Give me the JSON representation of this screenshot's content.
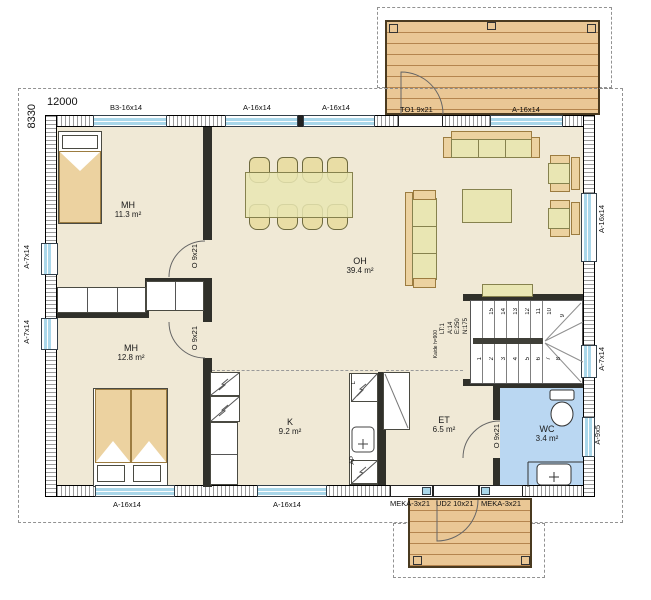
{
  "plan": {
    "dims": {
      "w": "12000",
      "h": "8330"
    },
    "rooms": {
      "mh1": {
        "name": "MH",
        "area": "11.3 m²"
      },
      "mh2": {
        "name": "MH",
        "area": "12.8 m²"
      },
      "oh": {
        "name": "OH",
        "area": "39.4 m²"
      },
      "k": {
        "name": "K",
        "area": "9.2 m²"
      },
      "et": {
        "name": "ET",
        "area": "6.5 m²"
      },
      "wc": {
        "name": "WC",
        "area": "3.4 m²"
      }
    },
    "windows": {
      "top": [
        "B3-16x14",
        "A-16x14",
        "A-16x14"
      ],
      "terrace_window": "A-16x14",
      "left": [
        "A-7x14",
        "A-7x14"
      ],
      "right": [
        "A-16x14",
        "A-7x14",
        "A-9x5"
      ],
      "bottom": [
        "A-16x14",
        "A-16x14"
      ]
    },
    "doors": {
      "terrace": "TO1 9x21",
      "entry": "UD2 10x21",
      "entry_sidelights": [
        "MEKA-3x21",
        "MEKA-3x21"
      ],
      "interior": [
        "O 9x21",
        "O 9x21",
        "O 9x21"
      ]
    },
    "stairs": {
      "info": [
        "LT:1",
        "A:14",
        "E:250",
        "N:175"
      ],
      "handrail": "Kaide h=900",
      "steps_lower": [
        "1",
        "2",
        "3",
        "4",
        "5",
        "6",
        "7",
        "8"
      ],
      "steps_upper": [
        "15",
        "14",
        "13",
        "12",
        "11",
        "10"
      ],
      "step_corner": "9"
    },
    "kitchen": {
      "appliances": {
        "stove": "L",
        "dishwasher": "AP"
      }
    },
    "colors": {
      "floor": "#f0e9d6",
      "wood_deck": "#eac795",
      "furniture_green": "#e9e6b3",
      "furniture_tan": "#ecd2a0",
      "window_glass": "#a9d7ea",
      "wc_floor": "#bad7f2",
      "wall": "#111111"
    }
  }
}
